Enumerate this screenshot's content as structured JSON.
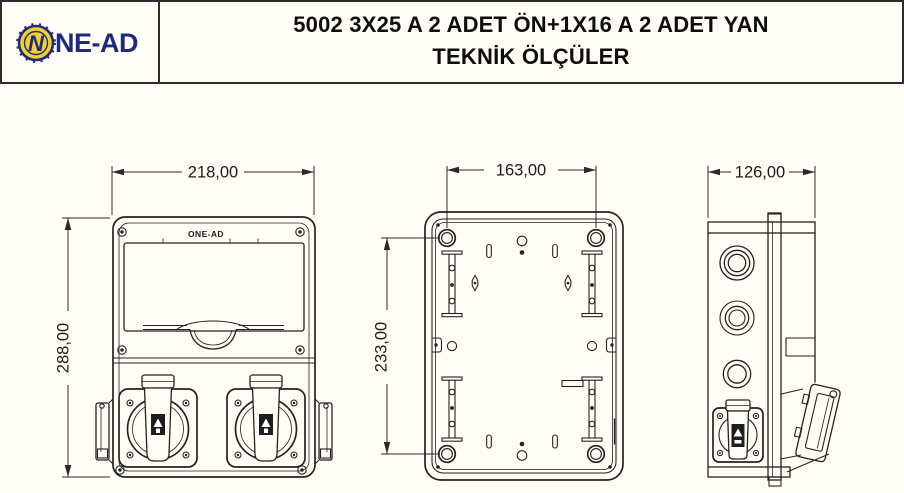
{
  "header": {
    "logo": {
      "symbol": "N",
      "text": "NE-AD"
    },
    "title_line1": "5002 3X25 A 2 ADET ÖN+1X16 A 2 ADET YAN",
    "title_line2": "TEKNİK ÖLÇÜLER"
  },
  "views": {
    "front": {
      "dim_width": "218,00",
      "dim_height": "288,00",
      "brand": "ONE-AD"
    },
    "back": {
      "dim_width": "163,00",
      "dim_height": "233,00"
    },
    "side": {
      "dim_width": "126,00"
    }
  },
  "colors": {
    "navy": "#1e2b7d",
    "yellow": "#f2d12b",
    "line": "#232323",
    "paper": "#fffdf6"
  }
}
